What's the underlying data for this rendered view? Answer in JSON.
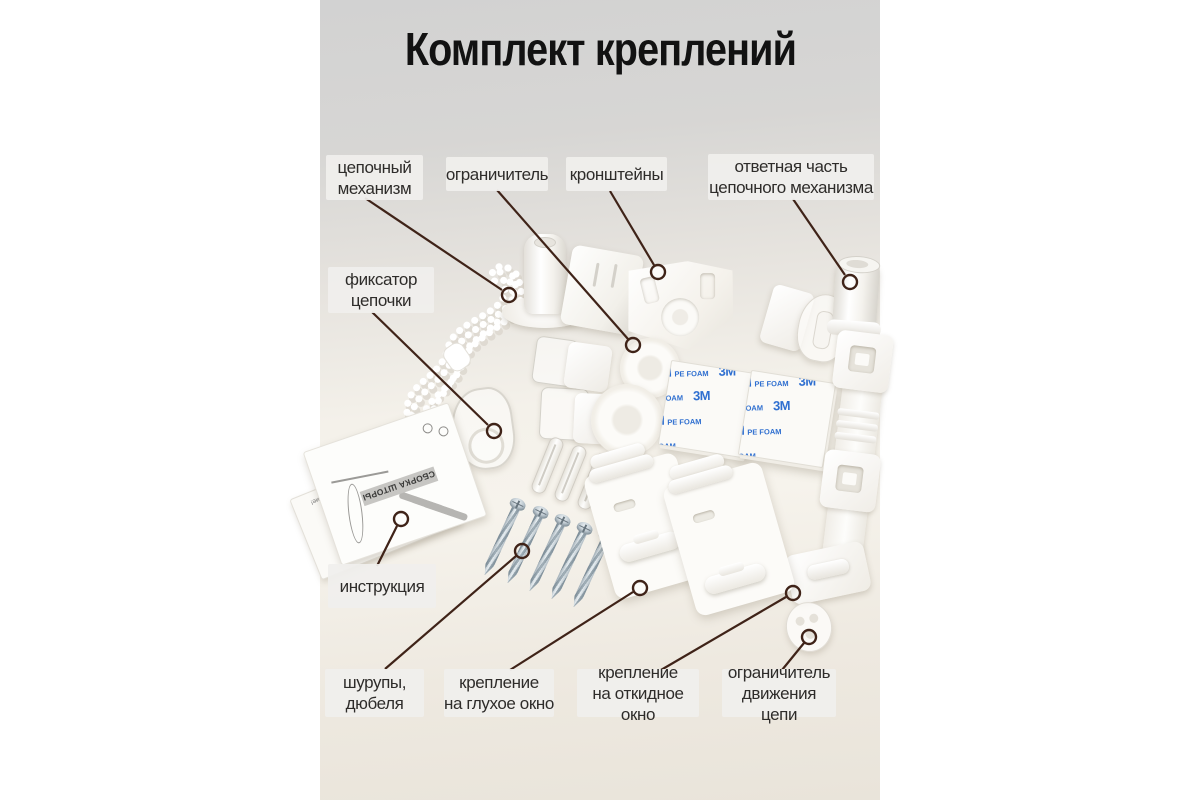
{
  "title": "Комплект креплений",
  "labels": [
    {
      "id": "chain-mechanism",
      "text": "цепочный\nмеханизм"
    },
    {
      "id": "stopper",
      "text": "ограничитель"
    },
    {
      "id": "brackets",
      "text": "кронштейны"
    },
    {
      "id": "chain-counterpart",
      "text": "ответная часть\nцепочного механизма"
    },
    {
      "id": "chain-fixator",
      "text": "фиксатор\nцепочки"
    },
    {
      "id": "instruction",
      "text": "инструкция"
    },
    {
      "id": "screws-dowels",
      "text": "шурупы,\nдюбеля"
    },
    {
      "id": "fixed-window-mount",
      "text": "крепление\nна глухое окно"
    },
    {
      "id": "tilt-window-mount",
      "text": "крепление\nна откидное окно"
    },
    {
      "id": "chain-motion-limiter",
      "text": "ограничитель\nдвижения цепи"
    }
  ],
  "photo": {
    "brand": "3M",
    "brand_sub": "PE FOAM",
    "leaflet_caption": "СБОРКА ШТОРЫ",
    "leaflet_note": "Внимание!"
  },
  "colors": {
    "leader_line": "#3F2318",
    "label_bg": "#F0EFED",
    "title_text": "#121212",
    "foam_text_blue": "#2F6FD0",
    "backdrop_top": "#D2D2D2",
    "surface": "#F4F1EA"
  }
}
